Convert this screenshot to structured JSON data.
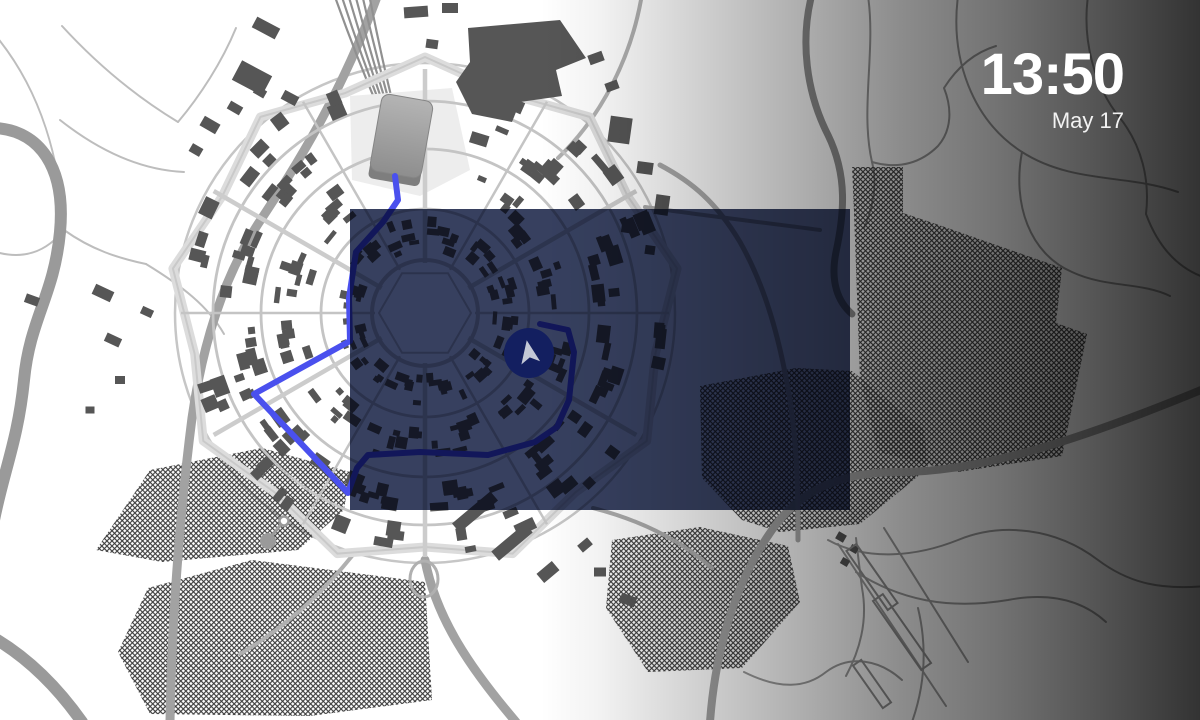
{
  "clock": {
    "time": "13:50",
    "date": "May 17"
  },
  "map": {
    "colors": {
      "map_background": "#ffffff",
      "building": "#565656",
      "road_minor": "#c4c4c4",
      "road_major": "#a2a2a2",
      "road_wide": "#9a9a9a",
      "road_field": "#bdbdbd",
      "road_far": "#9c9c9c",
      "railway": "#909090",
      "hatch_line": "#3a3a3a",
      "route_blue": "#4a50ee",
      "overlay_tint": "#404a6a",
      "overlay_veil": "rgba(16,22,52,0.18)",
      "puck_fill": "#131f60",
      "puck_arrow": "#c3c8d6",
      "station_top": "#b4b4b4",
      "station_bottom": "#8e8e8e",
      "clock_text": "#ffffff"
    }
  }
}
